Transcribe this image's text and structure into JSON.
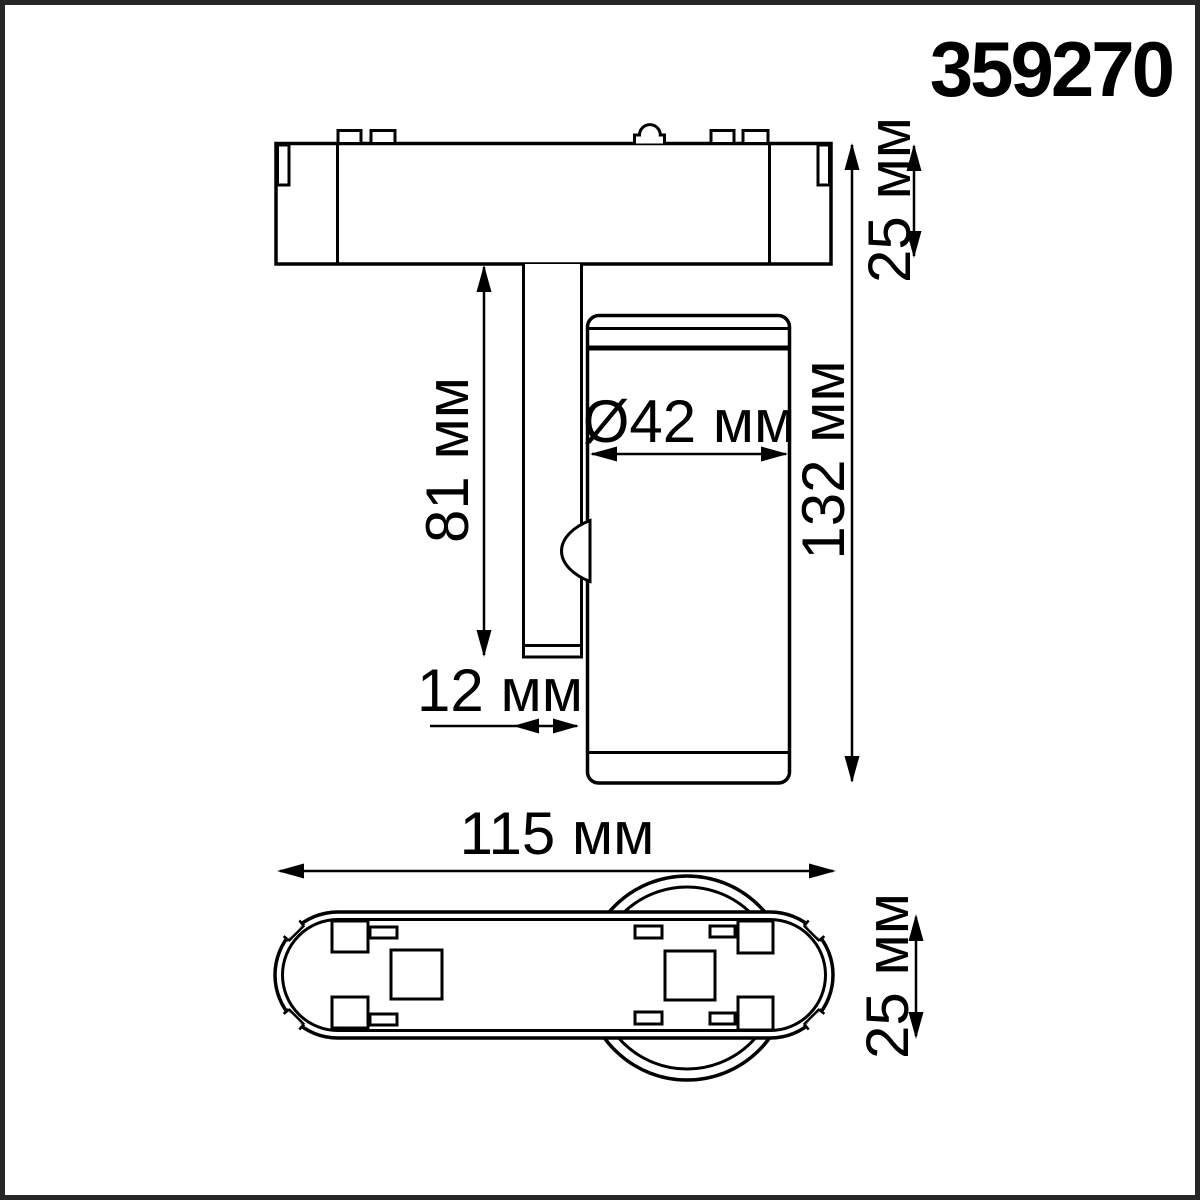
{
  "page": {
    "background": "#ffffff",
    "line_color": "#000000",
    "frame_color": "#262626"
  },
  "drawing": {
    "part_number": "359270",
    "units": "мм",
    "side_view": {
      "labels": {
        "adapter_height": "25 мм",
        "total_height": "132 мм",
        "stem_length": "81 мм",
        "head_diameter": "Ø42 мм",
        "stem_width": "12 мм"
      },
      "values_mm": {
        "adapter_height": 25,
        "total_height": 132,
        "stem_length": 81,
        "head_diameter": 42,
        "stem_width": 12
      }
    },
    "bottom_view": {
      "labels": {
        "body_length": "115 мм",
        "body_width": "25 мм"
      },
      "values_mm": {
        "body_length": 115,
        "body_width": 25
      }
    }
  }
}
